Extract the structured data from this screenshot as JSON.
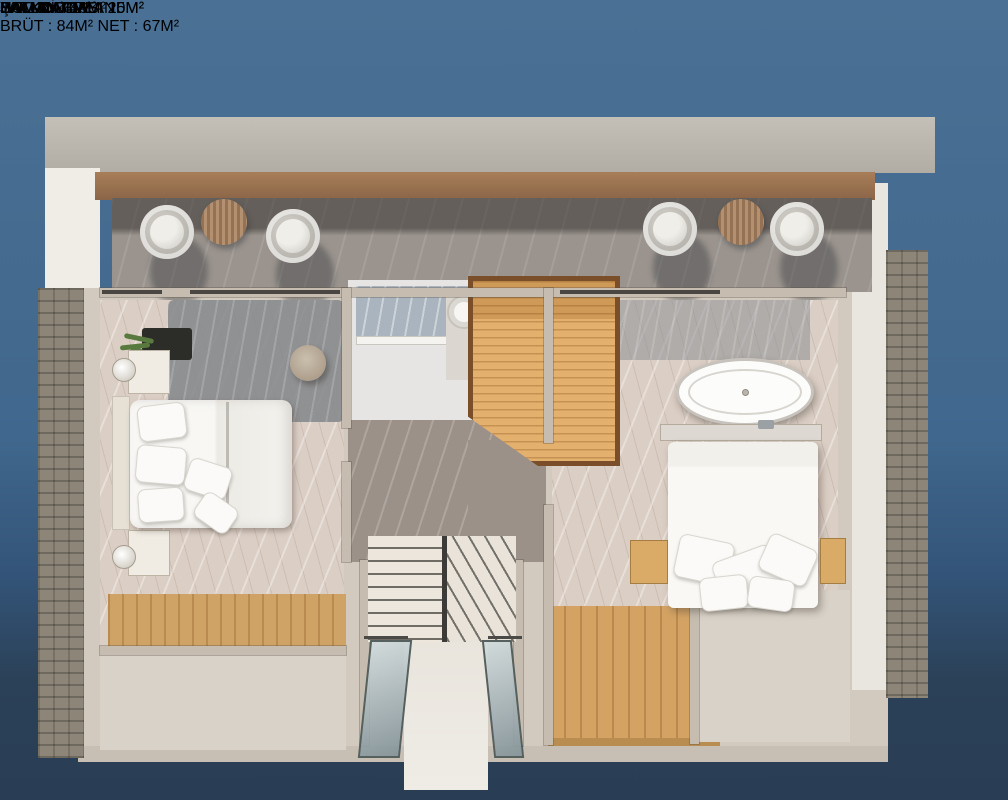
{
  "title_panel": {
    "title": "ÇATI KAT PLANI",
    "brut_label": "BRÜT :",
    "brut_value": "84",
    "net_label": "NET :",
    "net_value": "67",
    "unit": "M²"
  },
  "area_unit": "M²",
  "rooms": {
    "balkon_top": {
      "name": "BALKON",
      "area": "16"
    },
    "hamam_left": {
      "name": "HAMAM",
      "area": "3"
    },
    "hamam_right": {
      "name": "HAMAM",
      "area": "4"
    },
    "jakuzi": {
      "name": "JAKUZİ"
    },
    "hol": {
      "name": "HOL",
      "area": "4"
    },
    "yatak_left": {
      "name": "YATAK ODASI",
      "area": "15"
    },
    "yatak_right": {
      "name": "YATAK ODASI",
      "area": "20"
    },
    "balkon_left": {
      "name": "BALKON",
      "area": "4"
    },
    "balkon_right": {
      "name": "BALKON",
      "area": "3"
    }
  },
  "colors": {
    "background_top": "#4a7095",
    "background_bottom": "#293e54",
    "panel": "#1c2d3c",
    "label_border": "#141414"
  }
}
